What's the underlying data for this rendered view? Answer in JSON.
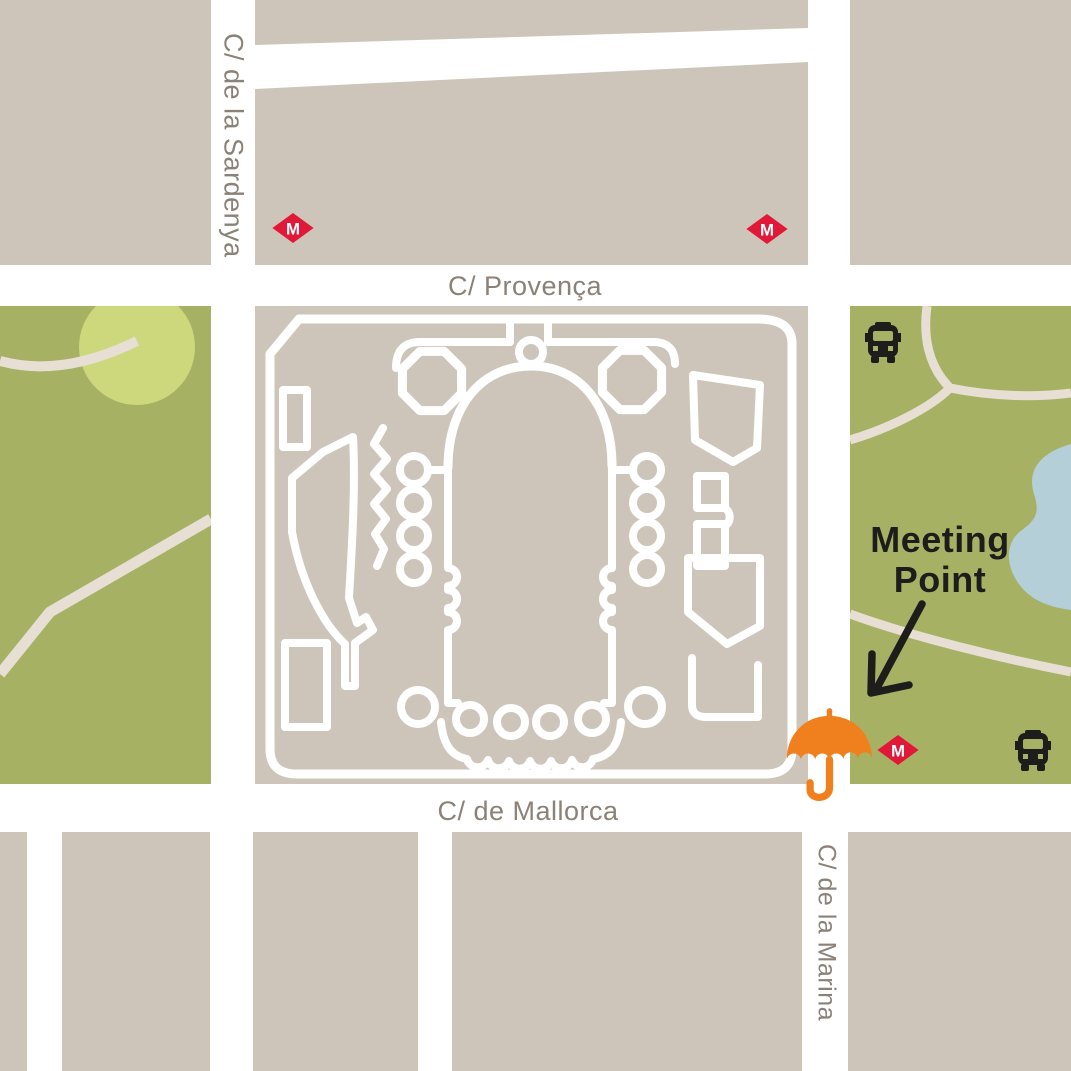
{
  "map": {
    "streets": {
      "sardenya": "C/ de la Sardenya",
      "provenca": "C/ Provença",
      "mallorca": "C/ de Mallorca",
      "marina": "C/ de la Marina"
    },
    "annotation": {
      "line1": "Meeting",
      "line2": "Point"
    },
    "transit": {
      "metro_label": "M"
    },
    "icons": {
      "metro": "metro-diamond-icon",
      "bus": "bus-icon",
      "umbrella": "umbrella-meeting-point-icon",
      "arrow": "arrow-down-left-icon"
    },
    "colors": {
      "block_beige": "#cec5ba",
      "street_white": "#ffffff",
      "park_green": "#a7b164",
      "park_light_circle": "#cdd77b",
      "park_path": "#e7ded4",
      "pond_blue": "#b4cfd7",
      "metro_red": "#e11938",
      "umbrella_orange": "#f0801e",
      "text_black": "#1d1d1b",
      "label_gray": "#8b8177"
    }
  }
}
